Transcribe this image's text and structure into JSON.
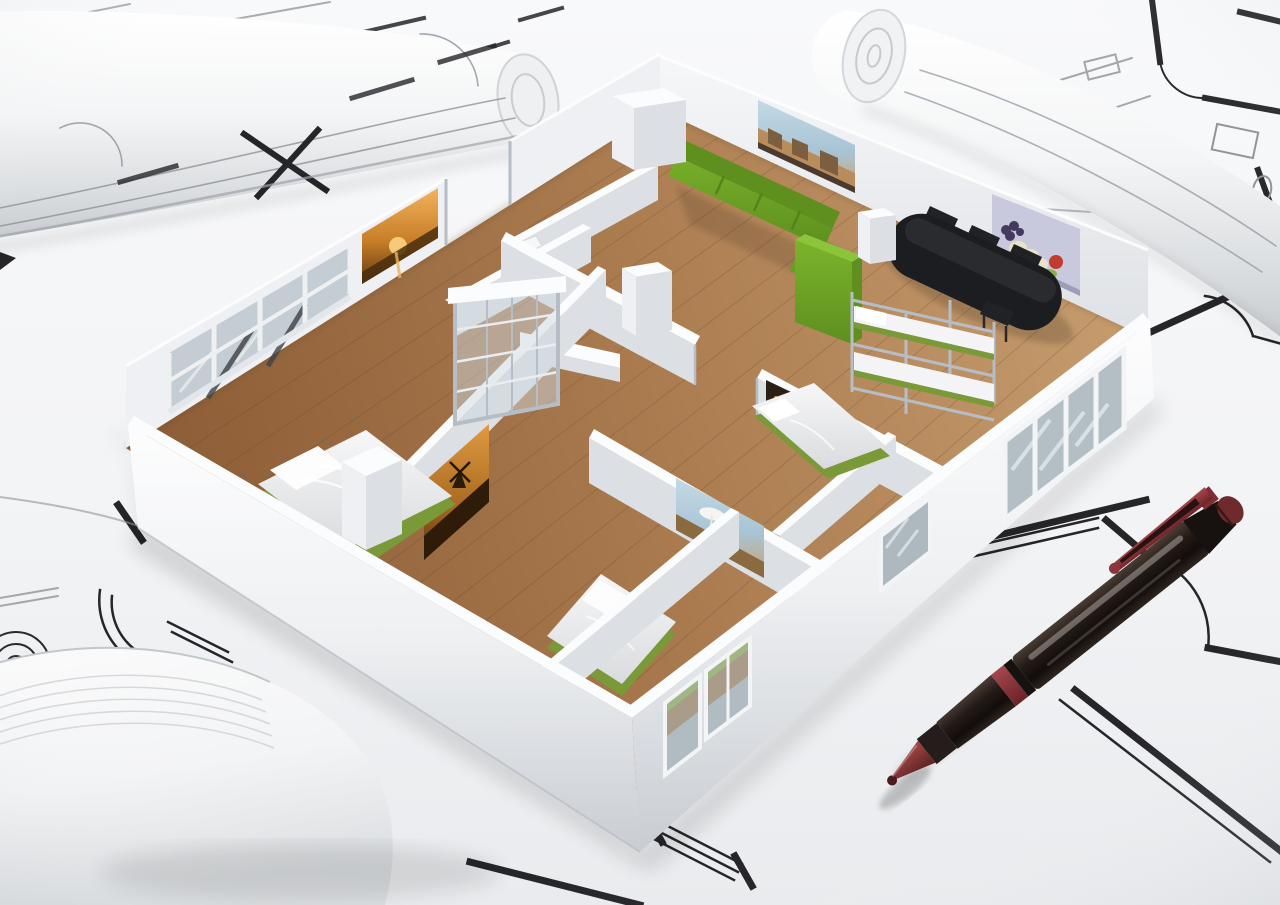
{
  "scene": {
    "type": "3d-architectural-render",
    "description": "Photorealistic 3D cutaway model of a furnished apartment floor plan standing on white architectural blueprint sheets, with rolled-up plans around it and a dark red ballpoint pen resting on the drawings at the lower right.",
    "inventory": [
      "blueprint sheets with black plan lines",
      "rolled blueprint top left",
      "rolled blueprint top right",
      "rolled paper bottom left",
      "apartment cutaway model",
      "green sofa",
      "black oval dining table with chairs",
      "green wardrobe",
      "metal bunk bed",
      "single bed",
      "double beds",
      "glass sliding closet",
      "bathroom with toilet",
      "wall art: cityscape, still life, sunset, windmill, beach, harbor",
      "windows and glass doors",
      "dark red ballpoint pen"
    ],
    "colors": {
      "paper": "#f3f4f6",
      "paper_deep": "#e2e5e8",
      "ink": "#26262a",
      "ink_soft": "#8f9398",
      "wall_top": "#fbfcfd",
      "wall_face": "#eef0f3",
      "wall_face_dark": "#dce0e5",
      "wood_dark": "#8d5e37",
      "wood_mid": "#aa7b4f",
      "wood_light": "#c59c6e",
      "sofa_green": "#7cb42c",
      "green_dark": "#5e8f1f",
      "furn_black": "#1c1d20",
      "mattress": "#f4f4f6",
      "glass": "#c4cdd3",
      "frame_metal": "#b7bdc4",
      "pen_body": "#241b17",
      "pen_accent": "#8a3137",
      "art_orange": "#d98a35",
      "art_sky": "#9ec0d6",
      "art_lavender": "#c9c9de",
      "art_red": "#c23b2f",
      "art_cream": "#eae3c4",
      "art_fruit_green": "#86b04a"
    }
  }
}
